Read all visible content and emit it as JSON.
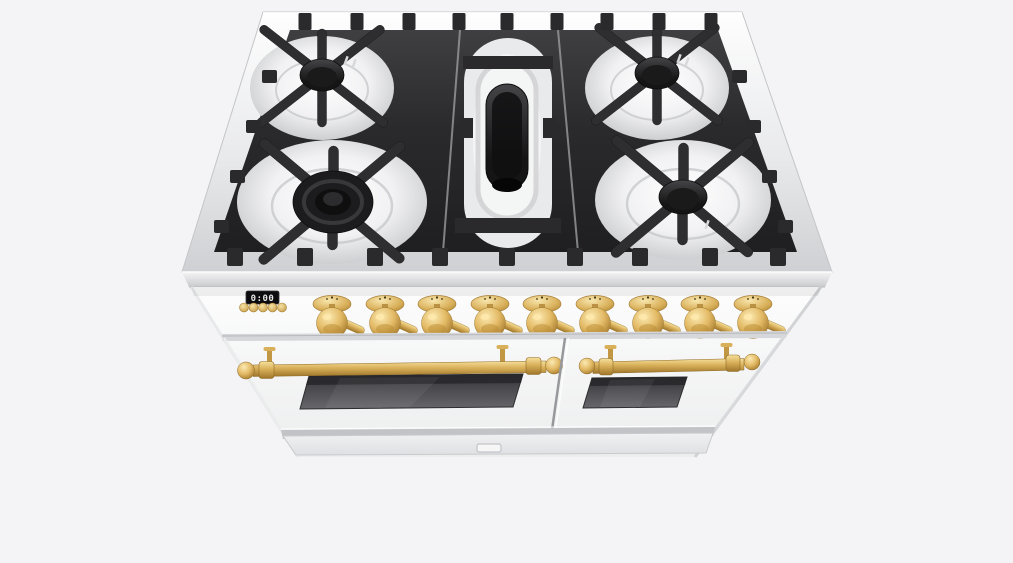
{
  "meta": {
    "description": "3D product render of a white freestanding double-oven gas range with brass knobs and rail handles, cast-iron cooktop grates, viewed from the front at a high angle",
    "background_color": "#f4f4f6"
  },
  "colors": {
    "background": "#f4f4f6",
    "body_white": "#fbfbfc",
    "rim_steel": "#e3e4e6",
    "grate_black": "#2b2b2d",
    "burner_cap_black": "#161617",
    "brass": "#d9b05a",
    "brass_light": "#f4dc96",
    "brass_dark": "#a97f2e",
    "oven_window": "#4a4a4e",
    "display_bg": "#0c0c0e",
    "display_text": "#e8e8e8"
  },
  "cooktop": {
    "grate_sections": 3,
    "burners": [
      {
        "name": "burner-back-left",
        "type": "round"
      },
      {
        "name": "burner-front-left",
        "type": "double-ring"
      },
      {
        "name": "burner-center",
        "type": "oval"
      },
      {
        "name": "burner-back-right",
        "type": "round"
      },
      {
        "name": "burner-front-right",
        "type": "round"
      }
    ]
  },
  "control_panel": {
    "display": {
      "value": "0:00"
    },
    "button_row_y": 307.5,
    "buttons": [
      {
        "name": "clock-button-1",
        "cx": 244
      },
      {
        "name": "clock-button-2",
        "cx": 253.5
      },
      {
        "name": "clock-button-3",
        "cx": 263
      },
      {
        "name": "clock-button-4",
        "cx": 272.5
      },
      {
        "name": "clock-button-5",
        "cx": 282
      }
    ],
    "knob_row_y": 304,
    "knobs": [
      {
        "name": "burner-knob-1",
        "x": 332
      },
      {
        "name": "burner-knob-2",
        "x": 385
      },
      {
        "name": "burner-knob-3",
        "x": 437
      },
      {
        "name": "burner-knob-4",
        "x": 490
      },
      {
        "name": "burner-knob-5",
        "x": 542
      },
      {
        "name": "burner-knob-6",
        "x": 595
      },
      {
        "name": "burner-knob-7",
        "x": 648
      },
      {
        "name": "burner-knob-8",
        "x": 700
      },
      {
        "name": "burner-knob-9",
        "x": 753
      }
    ]
  },
  "ovens": {
    "left_door": {
      "name": "left-oven-door",
      "has_window": true,
      "handle": "brass rail"
    },
    "right_door": {
      "name": "right-oven-door",
      "has_window": true,
      "handle": "brass rail"
    }
  },
  "base": {
    "latch": {
      "name": "drawer-latch"
    }
  }
}
